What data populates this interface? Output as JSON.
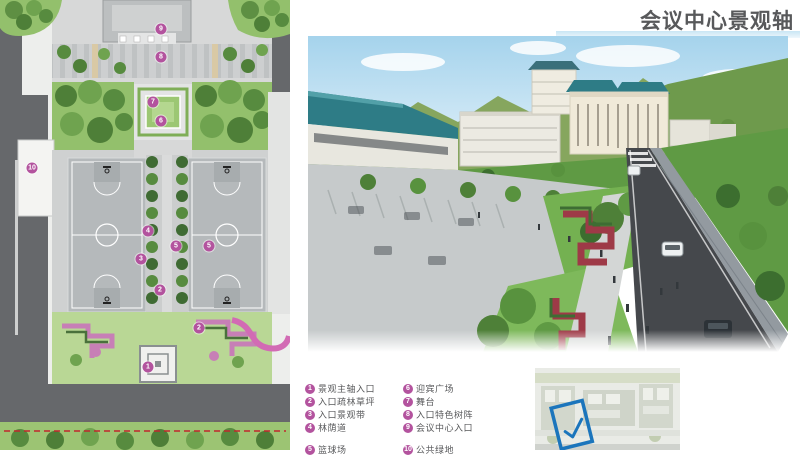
{
  "page": {
    "title": "会议中心景观轴"
  },
  "colors": {
    "title": "#58595b",
    "accentBar": "#c9e6f4",
    "legendMarker": "#b3539e",
    "legendText": "#58595b",
    "roadGrey": "#66686b",
    "planGreen": "#93c06c",
    "planGreenDark": "#4e7f38",
    "courtGrey": "#b5b9bb",
    "pavement": "#d7d8d8",
    "flowerPink": "#c77fb6",
    "boundaryRed": "#c1272d",
    "skyBlue": "#a5d3ec",
    "mountainGreen": "#86a65e",
    "roofTeal": "#2e7c86",
    "plazaGrey": "#c6cacb",
    "lawnGreen": "#74b151",
    "flowerRed": "#9e3a47",
    "asphalt": "#45484c",
    "highlightBlue": "#1b75bc"
  },
  "legend": {
    "columns": [
      {
        "items": [
          {
            "num": "1",
            "label": "景观主轴入口"
          },
          {
            "num": "2",
            "label": "入口疏林草坪"
          },
          {
            "num": "3",
            "label": "入口景观带"
          },
          {
            "num": "4",
            "label": "林荫道"
          },
          {
            "num": "5",
            "label": "篮球场"
          }
        ]
      },
      {
        "items": [
          {
            "num": "6",
            "label": "迎宾广场"
          },
          {
            "num": "7",
            "label": "舞台"
          },
          {
            "num": "8",
            "label": "入口特色树阵"
          },
          {
            "num": "9",
            "label": "会议中心入口"
          },
          {
            "num": "10",
            "label": "公共绿地"
          }
        ]
      }
    ]
  },
  "plan": {
    "markers": [
      {
        "num": "9"
      },
      {
        "num": "8"
      },
      {
        "num": "7"
      },
      {
        "num": "6"
      },
      {
        "num": "10"
      },
      {
        "num": "4"
      },
      {
        "num": "5"
      },
      {
        "num": "5"
      },
      {
        "num": "3"
      },
      {
        "num": "2"
      },
      {
        "num": "2"
      },
      {
        "num": "1"
      }
    ]
  },
  "rendering": {
    "scene": "conference-center-landscape-axis-aerial-view",
    "elements": [
      "sky",
      "clouds",
      "mountains",
      "exhibition-hall",
      "conference-center-buildings",
      "parking-plaza",
      "landscape-axis-lawns",
      "red-flower-bands",
      "street-trees",
      "road",
      "cars",
      "pedestrians",
      "stone-wall"
    ]
  },
  "thumbnail": {
    "type": "masterplan-location-key",
    "highlight": "blue-rotated-rectangle-with-checkmark"
  }
}
